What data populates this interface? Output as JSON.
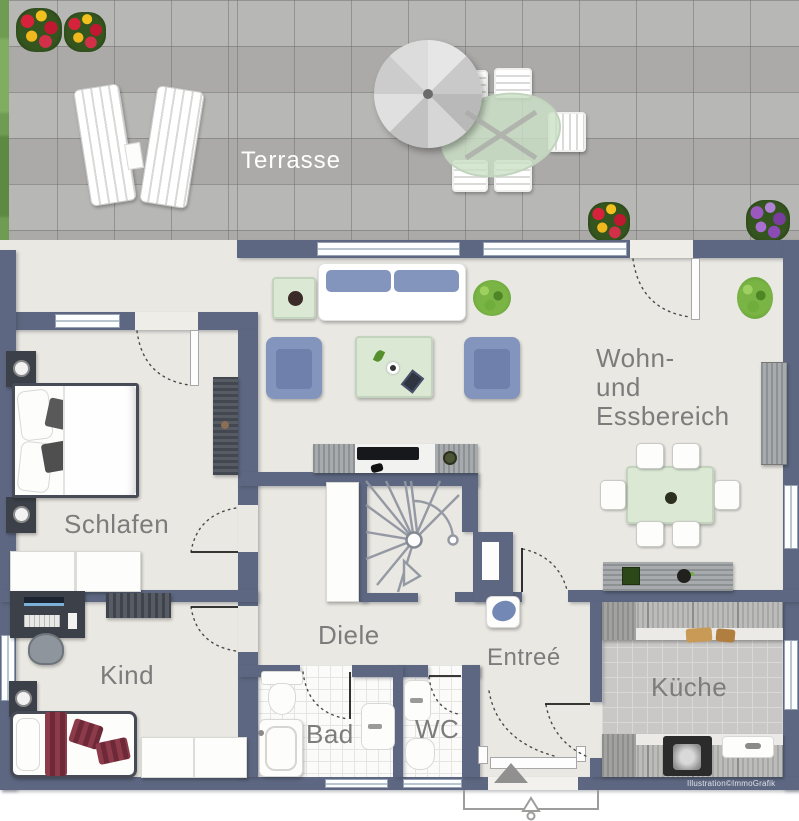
{
  "illustration": {
    "kind": "apartment floor plan with terrace",
    "credit": "Illustration©ImmoGrafik"
  },
  "rooms": {
    "terrasse": {
      "label": "Terrasse"
    },
    "wohn_essbereich": {
      "label_lines": [
        "Wohn-",
        "und",
        "Essbereich"
      ]
    },
    "schlafen": {
      "label": "Schlafen"
    },
    "kind": {
      "label": "Kind"
    },
    "diele": {
      "label": "Diele"
    },
    "entree": {
      "label": "Entreé"
    },
    "kueche": {
      "label": "Küche"
    },
    "bad": {
      "label": "Bad"
    },
    "wc": {
      "label": "WC"
    }
  },
  "colors": {
    "wall": "#5d6781",
    "interior_floor": "#eae8e2",
    "terrace_tile": "#b3b2b0",
    "bath_tile": "#fbfbfa",
    "kitchen_tile": "#c9c8c6",
    "furniture_blue": "#8495bd",
    "glass_green": "#d9e7d4",
    "accent_red": "#8d3b4b",
    "plant_green": "#6fae3c",
    "label_gray": "#7c7c7c",
    "terrace_label": "#ffffff"
  }
}
